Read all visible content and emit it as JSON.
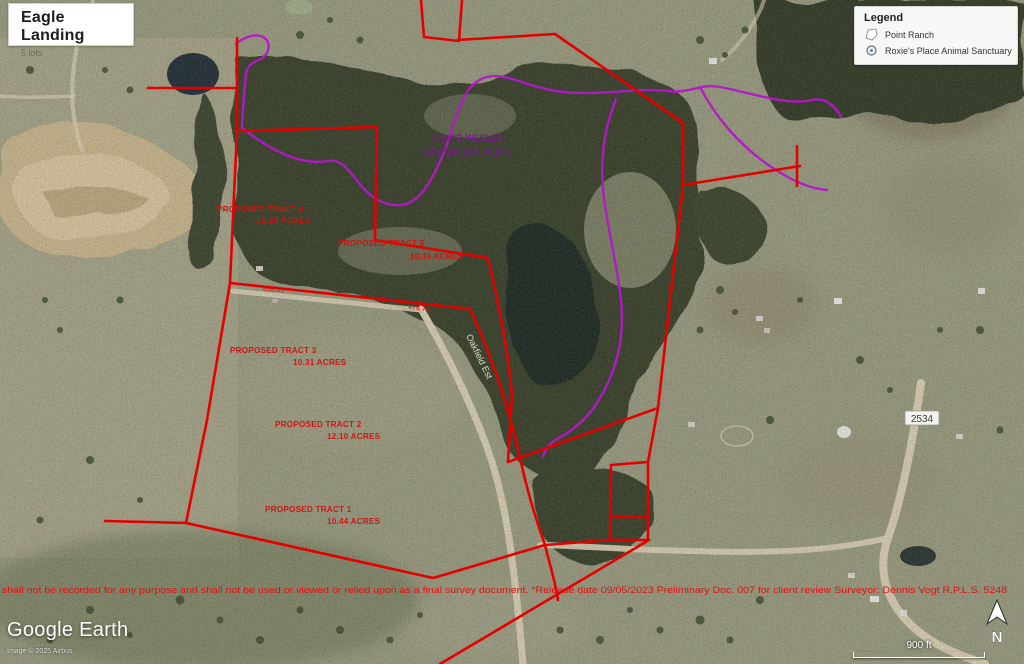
{
  "title_card": {
    "title": "Eagle Landing",
    "subtitle": "5 lots"
  },
  "legend": {
    "title": "Legend",
    "items": [
      {
        "label": "Point Ranch",
        "icon": "polygon-outline-icon"
      },
      {
        "label": "Roxie's Place Animal Sanctuary",
        "icon": "circle-marker-icon"
      }
    ]
  },
  "map": {
    "tracts": [
      {
        "name": "PROPOSED TRACT 4",
        "acres": "12.24 ACRES"
      },
      {
        "name": "PROPOSED TRACT 5",
        "acres": "10.16 ACRES"
      },
      {
        "name": "PROPOSED TRACT 3",
        "acres": "10.31 ACRES"
      },
      {
        "name": "PROPOSED TRACT 2",
        "acres": "12.10 ACRES"
      },
      {
        "name": "PROPOSED TRACT 1",
        "acres": "10.44 ACRES"
      }
    ],
    "survey": {
      "line1": "FLOYD WESLEY",
      "line2": "CARTER SVY, A-173"
    },
    "dimensions": [
      "658.65",
      "474.75"
    ],
    "roads": {
      "highway_shield": "2534",
      "road_label": "Oakfield Est"
    },
    "disclaimer": "shall not be recorded for any purpose and shall not be used or viewed or relied upon as a final survey document. *Release date 09/05/2023 Preliminary Doc. 007 for client review  Surveyor: Dennis Vogt R.P.L.S. 5248"
  },
  "attribution": {
    "logo": "Google Earth",
    "copyright": "Image © 2025 Airbus"
  },
  "scale": {
    "label": "900 ft"
  },
  "compass": {
    "label": "N"
  },
  "colors": {
    "boundary": "#e50000",
    "trail": "#b517c9",
    "label_red": "#d01212"
  }
}
